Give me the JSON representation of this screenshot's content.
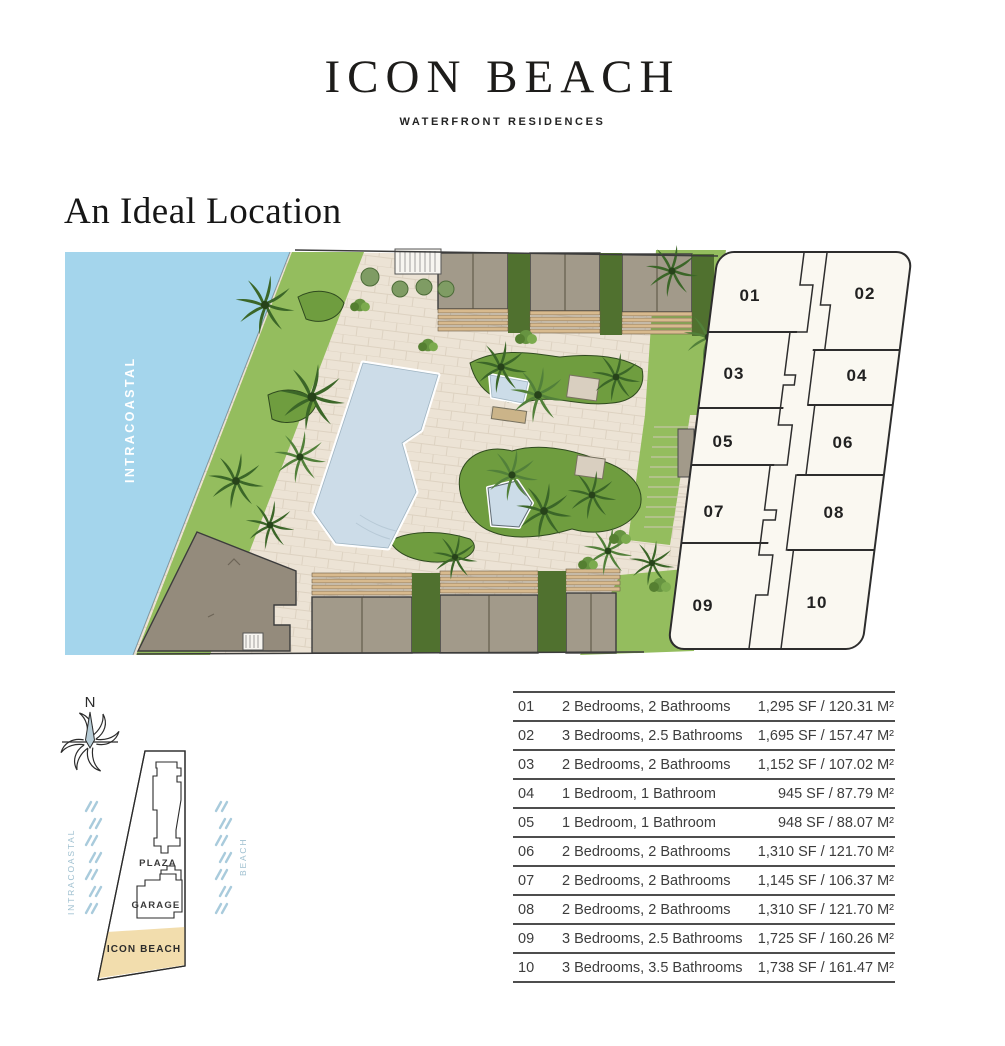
{
  "header": {
    "title": "ICON BEACH",
    "tagline": "WATERFRONT RESIDENCES"
  },
  "section_heading": "An Ideal Location",
  "site_plan": {
    "water_label": "INTRACOASTAL",
    "units": [
      "01",
      "02",
      "03",
      "04",
      "05",
      "06",
      "07",
      "08",
      "09",
      "10"
    ]
  },
  "location_map": {
    "compass_label": "N",
    "intracoastal_label": "INTRACOASTAL",
    "beach_label": "BEACH",
    "plaza_label": "PLAZA",
    "garage_label": "GARAGE",
    "site_label": "ICON BEACH"
  },
  "unit_table": {
    "rows": [
      {
        "num": "01",
        "type": "2 Bedrooms, 2 Bathrooms",
        "area": "1,295 SF / 120.31 M²"
      },
      {
        "num": "02",
        "type": "3 Bedrooms, 2.5 Bathrooms",
        "area": "1,695 SF / 157.47 M²"
      },
      {
        "num": "03",
        "type": "2 Bedrooms, 2 Bathrooms",
        "area": "1,152 SF / 107.02 M²"
      },
      {
        "num": "04",
        "type": "1 Bedroom, 1 Bathroom",
        "area": "945 SF / 87.79 M²"
      },
      {
        "num": "05",
        "type": "1 Bedroom, 1 Bathroom",
        "area": "948 SF / 88.07 M²"
      },
      {
        "num": "06",
        "type": "2 Bedrooms, 2 Bathrooms",
        "area": "1,310 SF / 121.70 M²"
      },
      {
        "num": "07",
        "type": "2 Bedrooms, 2 Bathrooms",
        "area": "1,145 SF / 106.37 M²"
      },
      {
        "num": "08",
        "type": "2 Bedrooms, 2 Bathrooms",
        "area": "1,310 SF / 121.70 M²"
      },
      {
        "num": "09",
        "type": "3 Bedrooms, 2.5 Bathrooms",
        "area": "1,725 SF / 160.26 M²"
      },
      {
        "num": "10",
        "type": "3 Bedrooms, 3.5 Bathrooms",
        "area": "1,738 SF / 161.47 M²"
      }
    ]
  },
  "colors": {
    "water": "#a4d5ec",
    "grass": "#94bd5e",
    "pavement": "#ece3d5",
    "roof": "#a29a8a",
    "pergola": "#d8ba8e",
    "pool": "#ccdce8",
    "plate_fill": "#faf8f1",
    "site_tan": "#f2ddad",
    "ink": "#2d2d2d",
    "table_text": "#3d3d3d",
    "map_blue": "#a9cbdc"
  }
}
